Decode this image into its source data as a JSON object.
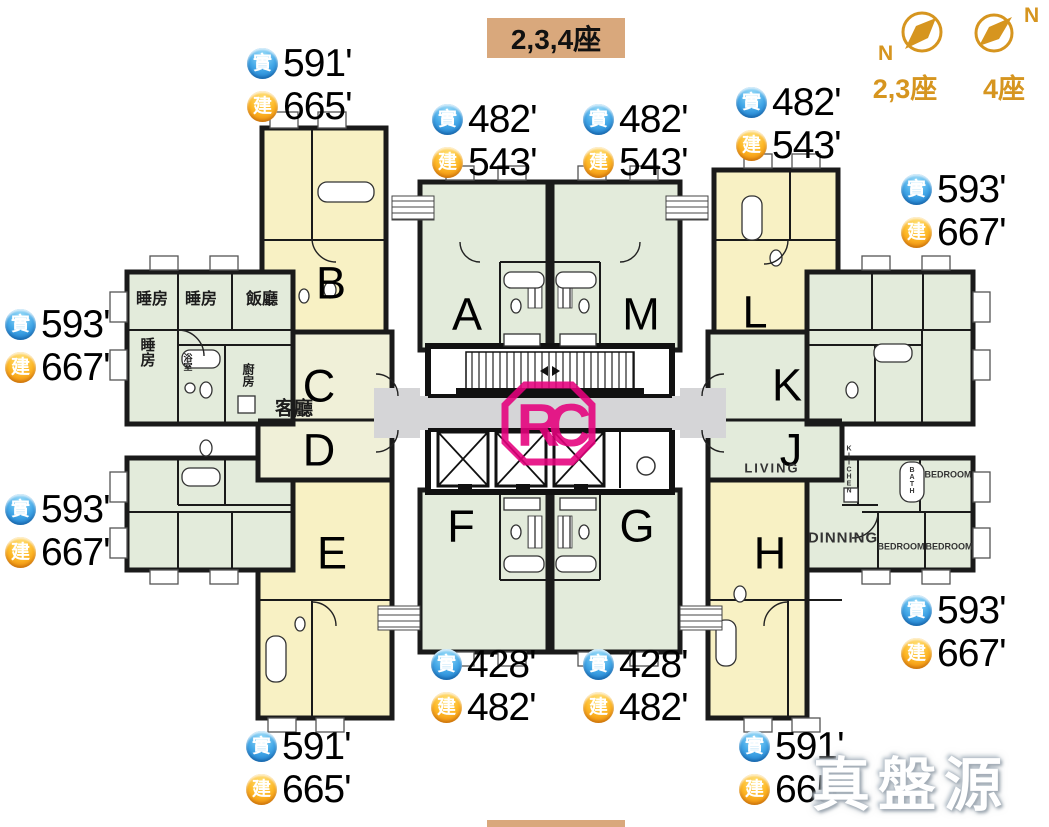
{
  "title": "2,3,4座",
  "compass": {
    "north": "N",
    "label_23": "2,3座",
    "label_4": "4座"
  },
  "badges": {
    "saleable": "實",
    "gross": "建"
  },
  "area_labels": [
    {
      "unit": "B",
      "saleable": "591'",
      "gross": "665'"
    },
    {
      "unit": "A",
      "saleable": "482'",
      "gross": "543'"
    },
    {
      "unit": "M",
      "saleable": "482'",
      "gross": "543'"
    },
    {
      "unit": "L",
      "saleable": "482'",
      "gross": "543'"
    },
    {
      "unit": "right-upper",
      "saleable": "593'",
      "gross": "667'"
    },
    {
      "unit": "left-upper",
      "saleable": "593'",
      "gross": "667'"
    },
    {
      "unit": "left-lower",
      "saleable": "593'",
      "gross": "667'"
    },
    {
      "unit": "right-lower",
      "saleable": "593'",
      "gross": "667'"
    },
    {
      "unit": "F",
      "saleable": "428'",
      "gross": "482'"
    },
    {
      "unit": "G",
      "saleable": "428'",
      "gross": "482'"
    },
    {
      "unit": "E",
      "saleable": "591'",
      "gross": "665'"
    },
    {
      "unit": "H",
      "saleable": "591'",
      "gross": "665'"
    }
  ],
  "units": {
    "a": "A",
    "b": "B",
    "c": "C",
    "d": "D",
    "e": "E",
    "f": "F",
    "g": "G",
    "h": "H",
    "j": "J",
    "k": "K",
    "l": "L",
    "m": "M"
  },
  "rooms": {
    "bedroom_cn": "睡房",
    "dining_cn": "飯廳",
    "living_cn": "客廳",
    "kitchen_cn": "廚房",
    "bath_cn": "浴室",
    "living_en": "LIVING",
    "dining_en": "DINNING",
    "bedroom_en": "BEDROOM",
    "kitchen_en": "KITCHEN",
    "bath_en": "BATH"
  },
  "logo_text": "RC",
  "watermark": "真盤源",
  "colors": {
    "unit_green": "#e3ebdb",
    "unit_yellow": "#f8f1c4",
    "unit_pale": "#f0f0d8",
    "corridor_gray": "#d5d5d7",
    "wall": "#1a1a1a",
    "compass_orange": "#d6951f",
    "title_bg": "#d9a87c",
    "logo_magenta": "#e5007d",
    "badge_blue": "#1a7fd4",
    "badge_orange": "#f08808"
  }
}
